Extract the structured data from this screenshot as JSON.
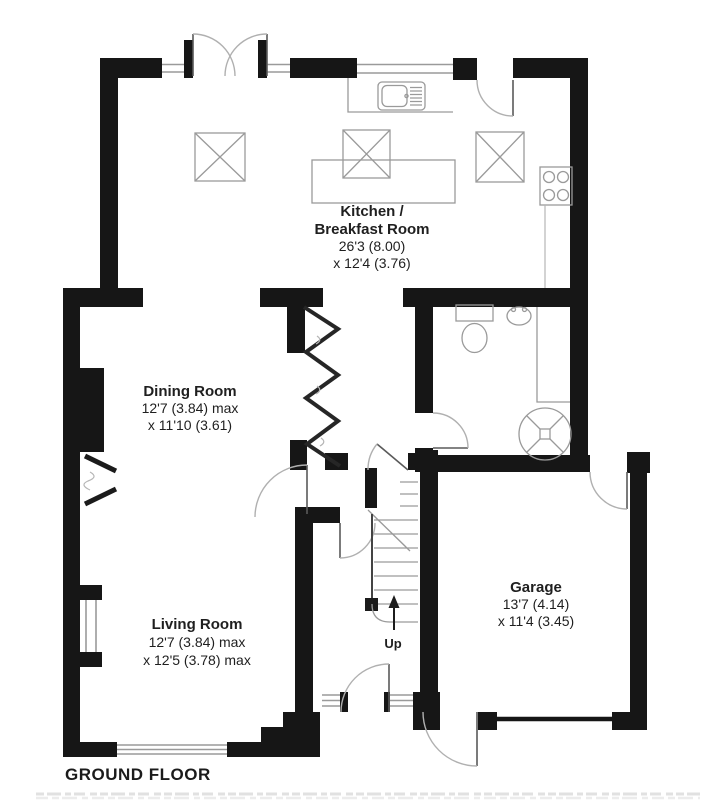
{
  "floor_plan": {
    "title": "GROUND FLOOR",
    "up_label": "Up",
    "rooms": [
      {
        "id": "kitchen-breakfast-room",
        "name_lines": [
          "Kitchen /",
          "Breakfast Room"
        ],
        "dim_lines": [
          "26'3 (8.00)",
          "x 12'4 (3.76)"
        ]
      },
      {
        "id": "dining-room",
        "name_lines": [
          "Dining Room"
        ],
        "dim_lines": [
          "12'7 (3.84) max",
          "x 11'10 (3.61)"
        ]
      },
      {
        "id": "living-room",
        "name_lines": [
          "Living Room"
        ],
        "dim_lines": [
          "12'7 (3.84) max",
          "x 12'5 (3.78) max"
        ]
      },
      {
        "id": "garage",
        "name_lines": [
          "Garage"
        ],
        "dim_lines": [
          "13'7 (4.14)",
          "x 11'4 (3.45)"
        ]
      }
    ],
    "fixture_symbols": [
      "french-doors",
      "kitchen-sink-drainer",
      "kitchen-counter",
      "kitchen-island",
      "rooflight",
      "rooflight",
      "rooflight",
      "hob",
      "toilet",
      "wash-basin",
      "shower-closet",
      "water-tank",
      "fireplace",
      "zigzag-partition",
      "staircase-up",
      "front-door",
      "garage-door",
      "side-door"
    ],
    "colors": {
      "wall": "#161616",
      "fixture_line": "#9a9a9a",
      "door_arc": "#b0b0b0",
      "text": "#1f1f1f",
      "background": "#ffffff"
    }
  }
}
